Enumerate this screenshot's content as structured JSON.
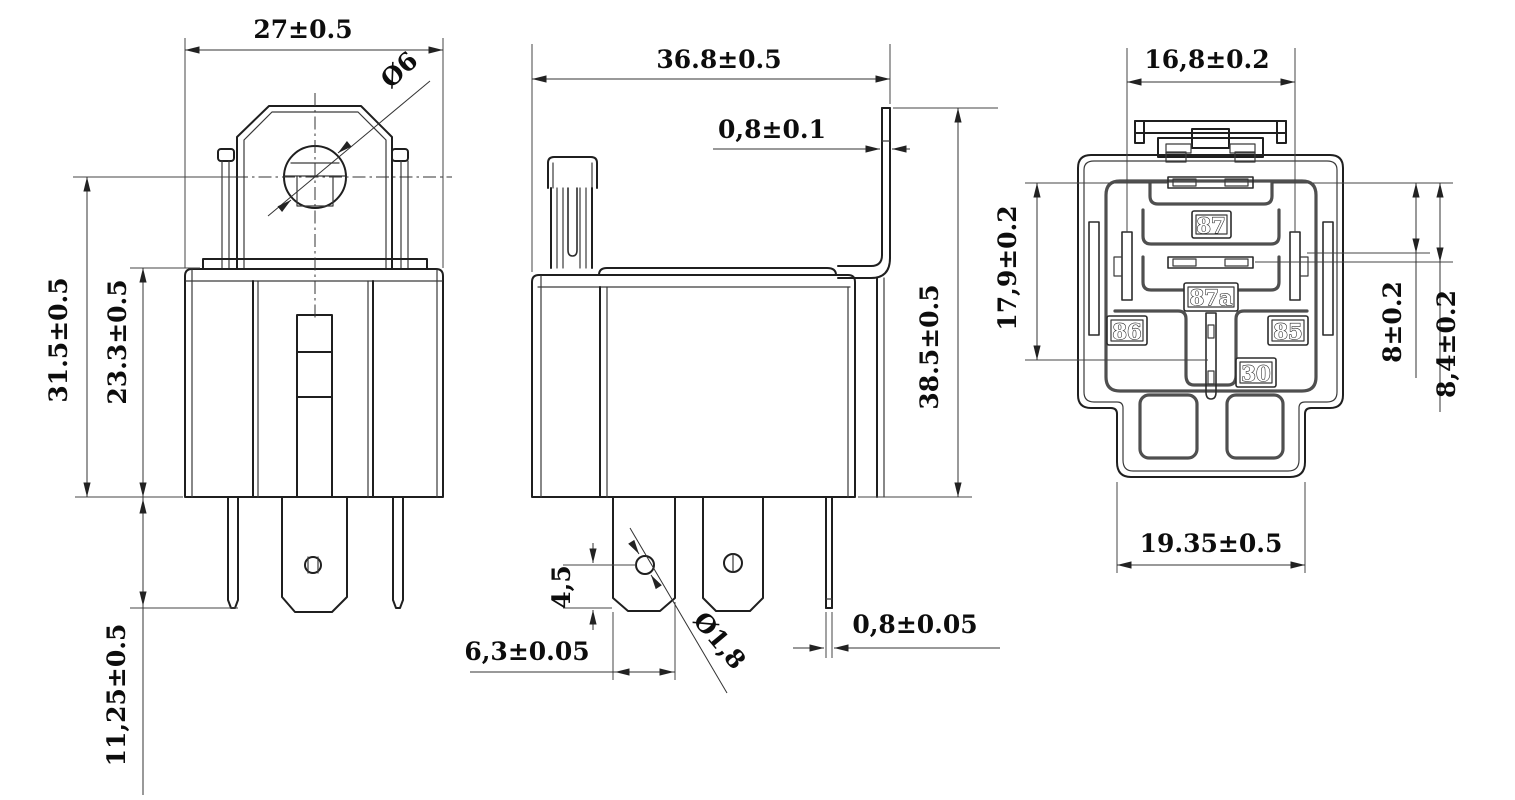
{
  "drawing": {
    "type": "relay-dimensional-drawing",
    "dims": {
      "front_width": "27±0.5",
      "mount_hole": "Ø6",
      "total_height": "31.5±0.5",
      "body_height": "23.3±0.5",
      "terminal_length": "11,25±0.5",
      "side_width": "36.8±0.5",
      "bracket_thk": "0,8±0.1",
      "side_height": "38.5±0.5",
      "hole_offset": "4,5",
      "terminal_width": "6,3±0.05",
      "terminal_hole": "Ø1,8",
      "terminal_thk": "0,8±0.05",
      "pin_span_width": "16,8±0.2",
      "pin_span_height": "17,9±0.2",
      "pin_offset_a": "8±0.2",
      "pin_offset_b": "8,4±0.2",
      "base_width": "19.35±0.5"
    },
    "terminals": {
      "no": "87",
      "nc": "87a",
      "coil_a": "86",
      "coil_b": "85",
      "common": "30"
    }
  }
}
